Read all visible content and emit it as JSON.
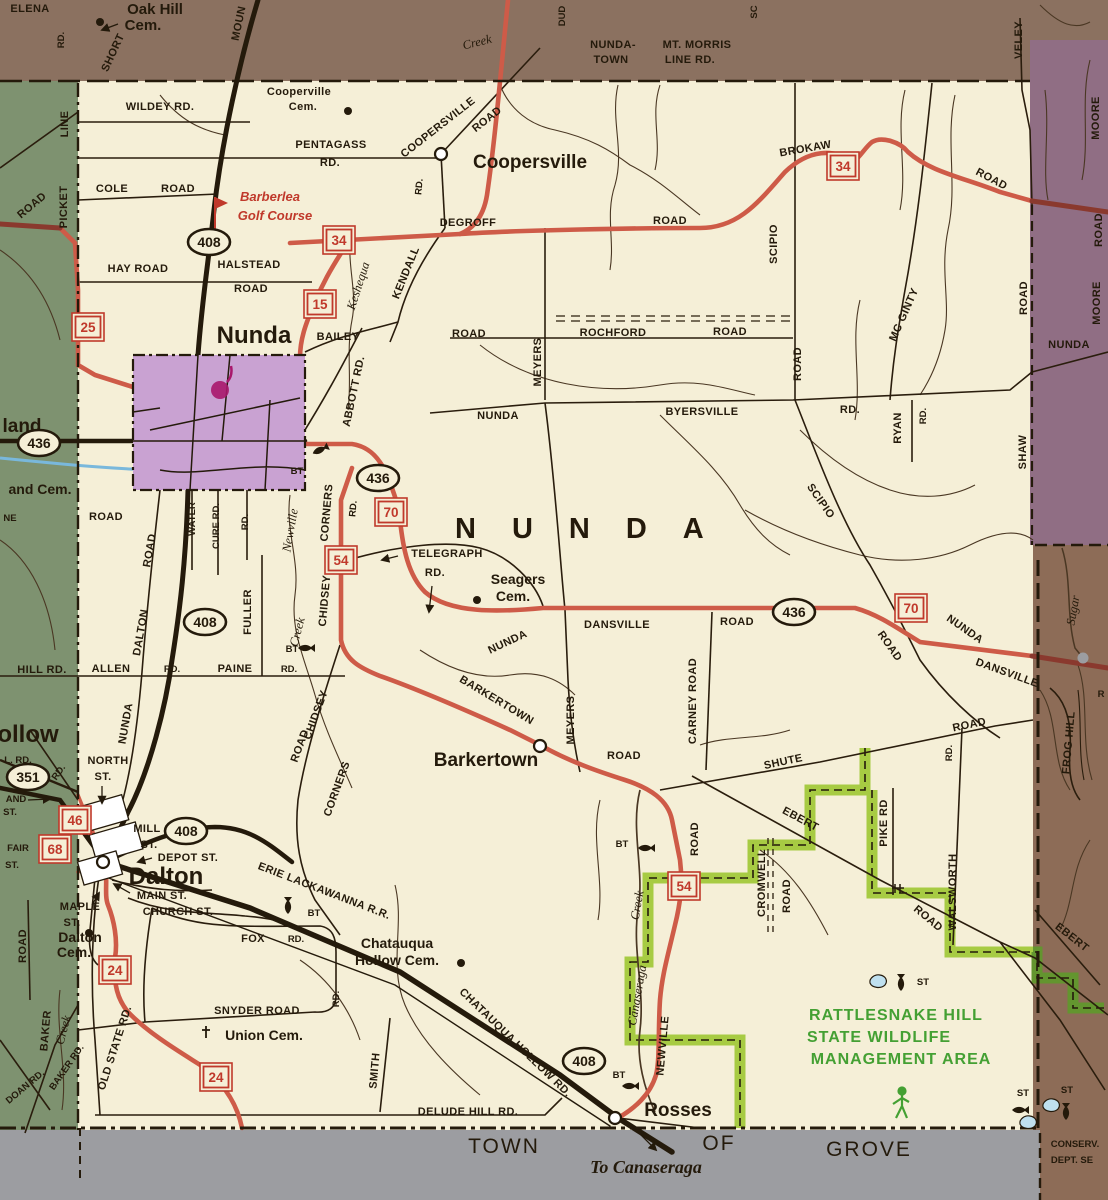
{
  "map_title": "Town of Nunda road map",
  "palette": {
    "cream": "#f5efd7",
    "brown_top": "#8b7160",
    "purple_east": "#906e84",
    "brown_east": "#8d6c57",
    "green_west": "#7e9270",
    "village_purple": "#c9a2d2",
    "gray_strip": "#9c9da1",
    "wildlife_green": "#a7cb43",
    "wildlife_dark": "#63952f",
    "route_red": "#ce5b48",
    "route_dark_red": "#8a392e",
    "ink": "#241a0b",
    "water_blue": "#79b8dc"
  },
  "labels": [
    {
      "t": "ELENA",
      "x": 30,
      "y": 12
    },
    {
      "t": "RD.",
      "x": 64,
      "y": 40,
      "r": -90,
      "c": "rds"
    },
    {
      "t": "Oak Hill",
      "x": 155,
      "y": 14,
      "c": "town",
      "fs": 15
    },
    {
      "t": "Cem.",
      "x": 143,
      "y": 30,
      "c": "town",
      "fs": 15
    },
    {
      "t": "SHORT",
      "x": 116,
      "y": 54,
      "r": -65
    },
    {
      "t": "MOUN",
      "x": 242,
      "y": 24,
      "r": -78
    },
    {
      "t": "Creek",
      "x": 478,
      "y": 46,
      "r": -14,
      "c": "creek"
    },
    {
      "t": "DUD",
      "x": 565,
      "y": 16,
      "r": -90,
      "c": "rds"
    },
    {
      "t": "NUNDA-",
      "x": 613,
      "y": 48
    },
    {
      "t": "TOWN",
      "x": 611,
      "y": 63
    },
    {
      "t": "MT. MORRIS",
      "x": 697,
      "y": 48
    },
    {
      "t": "LINE RD.",
      "x": 690,
      "y": 63
    },
    {
      "t": "SC",
      "x": 757,
      "y": 12,
      "r": -90,
      "c": "rds"
    },
    {
      "t": "VELEY",
      "x": 1022,
      "y": 40,
      "r": -90
    },
    {
      "t": "MOORE",
      "x": 1099,
      "y": 118,
      "r": -90
    },
    {
      "t": "ROAD",
      "x": 1102,
      "y": 230,
      "r": -90
    },
    {
      "t": "MOORE",
      "x": 1100,
      "y": 303,
      "r": -90
    },
    {
      "t": "NUNDA",
      "x": 1069,
      "y": 348
    },
    {
      "t": "WILDEY RD.",
      "x": 160,
      "y": 110
    },
    {
      "t": "Cooperville",
      "x": 299,
      "y": 95
    },
    {
      "t": "Cem.",
      "x": 303,
      "y": 110
    },
    {
      "t": "PENTAGASS",
      "x": 331,
      "y": 148
    },
    {
      "t": "RD.",
      "x": 330,
      "y": 166
    },
    {
      "t": "COOPERSVILLE",
      "x": 440,
      "y": 130,
      "r": -38
    },
    {
      "t": "ROAD",
      "x": 489,
      "y": 122,
      "r": -38
    },
    {
      "t": "Coopersville",
      "x": 530,
      "y": 168,
      "c": "town"
    },
    {
      "t": "COLE",
      "x": 112,
      "y": 192
    },
    {
      "t": "ROAD",
      "x": 178,
      "y": 192
    },
    {
      "t": "Barberlea",
      "x": 270,
      "y": 201,
      "c": "red-it"
    },
    {
      "t": "Golf Course",
      "x": 275,
      "y": 220,
      "c": "red-it"
    },
    {
      "t": "HAY ROAD",
      "x": 138,
      "y": 272
    },
    {
      "t": "HALSTEAD",
      "x": 249,
      "y": 268
    },
    {
      "t": "ROAD",
      "x": 251,
      "y": 292
    },
    {
      "t": "DEGROFF",
      "x": 468,
      "y": 226
    },
    {
      "t": "ROAD",
      "x": 670,
      "y": 224
    },
    {
      "t": "BROKAW",
      "x": 806,
      "y": 152,
      "r": -10
    },
    {
      "t": "ROAD",
      "x": 990,
      "y": 182,
      "r": 28
    },
    {
      "t": "KENDALL",
      "x": 409,
      "y": 274,
      "r": -68
    },
    {
      "t": "RD.",
      "x": 422,
      "y": 187,
      "r": -85,
      "c": "rds"
    },
    {
      "t": "Keshequa",
      "x": 362,
      "y": 287,
      "r": -72,
      "c": "creek"
    },
    {
      "t": "SCIPIO",
      "x": 777,
      "y": 244,
      "r": -90
    },
    {
      "t": "MC GINTY",
      "x": 907,
      "y": 316,
      "r": -66
    },
    {
      "t": "ROCHFORD",
      "x": 613,
      "y": 336
    },
    {
      "t": "ROAD",
      "x": 730,
      "y": 335
    },
    {
      "t": "ROAD",
      "x": 469,
      "y": 337
    },
    {
      "t": "MEYERS",
      "x": 541,
      "y": 362,
      "r": -90
    },
    {
      "t": "NUNDA",
      "x": 498,
      "y": 419
    },
    {
      "t": "BYERSVILLE",
      "x": 702,
      "y": 415
    },
    {
      "t": "RD.",
      "x": 850,
      "y": 413
    },
    {
      "t": "RYAN",
      "x": 901,
      "y": 428,
      "r": -90
    },
    {
      "t": "RD.",
      "x": 926,
      "y": 416,
      "r": -90,
      "c": "rds"
    },
    {
      "t": "ROAD",
      "x": 801,
      "y": 364,
      "r": -90
    },
    {
      "t": "SHAW",
      "x": 1026,
      "y": 452,
      "r": -90
    },
    {
      "t": "ROAD",
      "x": 1027,
      "y": 298,
      "r": -90
    },
    {
      "t": "BAILEY",
      "x": 338,
      "y": 340
    },
    {
      "t": "ABBOTT RD.",
      "x": 357,
      "y": 392,
      "r": -78
    },
    {
      "t": "Nunda",
      "x": 254,
      "y": 343,
      "c": "town-lg"
    },
    {
      "t": "BT",
      "x": 297,
      "y": 474,
      "c": "rds"
    },
    {
      "t": "NUNDA",
      "x": 455,
      "y": 538,
      "c": "spread",
      "an": "start"
    },
    {
      "t": "land",
      "x": 22,
      "y": 432,
      "c": "town"
    },
    {
      "t": "and Cem.",
      "x": 40,
      "y": 494,
      "c": "town",
      "fs": 14
    },
    {
      "t": "NE",
      "x": 10,
      "y": 521,
      "c": "rds"
    },
    {
      "t": "ROAD",
      "x": 106,
      "y": 520
    },
    {
      "t": "ROAD",
      "x": 34,
      "y": 208,
      "r": -40
    },
    {
      "t": "LINE",
      "x": 68,
      "y": 124,
      "r": -90
    },
    {
      "t": "PICKET",
      "x": 67,
      "y": 207,
      "r": -90
    },
    {
      "t": "HILL RD.",
      "x": 42,
      "y": 673
    },
    {
      "t": "ALLEN",
      "x": 111,
      "y": 672
    },
    {
      "t": "RD.",
      "x": 172,
      "y": 672,
      "c": "rds"
    },
    {
      "t": "PAINE",
      "x": 235,
      "y": 672
    },
    {
      "t": "RD.",
      "x": 289,
      "y": 672,
      "c": "rds"
    },
    {
      "t": "DALTON",
      "x": 144,
      "y": 633,
      "r": -80
    },
    {
      "t": "NUNDA",
      "x": 129,
      "y": 724,
      "r": -80
    },
    {
      "t": "ROAD",
      "x": 153,
      "y": 551,
      "r": -80
    },
    {
      "t": "WATER",
      "x": 195,
      "y": 519,
      "r": -90,
      "c": "rds"
    },
    {
      "t": "CURE RD.",
      "x": 219,
      "y": 526,
      "r": -90,
      "c": "rds"
    },
    {
      "t": "RD.",
      "x": 248,
      "y": 522,
      "r": -90,
      "c": "rds"
    },
    {
      "t": "FULLER",
      "x": 251,
      "y": 612,
      "r": -90
    },
    {
      "t": "Newville",
      "x": 294,
      "y": 531,
      "r": -80,
      "c": "creek"
    },
    {
      "t": "Creek",
      "x": 301,
      "y": 633,
      "r": -75,
      "c": "creek"
    },
    {
      "t": "CORNERS",
      "x": 330,
      "y": 513,
      "r": -85
    },
    {
      "t": "CHIDSEY",
      "x": 328,
      "y": 601,
      "r": -85
    },
    {
      "t": "RD.",
      "x": 356,
      "y": 509,
      "r": -85,
      "c": "rds"
    },
    {
      "t": "CHIDSEY",
      "x": 319,
      "y": 716,
      "r": -70
    },
    {
      "t": "CORNERS",
      "x": 340,
      "y": 790,
      "r": -70
    },
    {
      "t": "ROAD",
      "x": 303,
      "y": 747,
      "r": -70
    },
    {
      "t": "TELEGRAPH",
      "x": 447,
      "y": 557
    },
    {
      "t": "RD.",
      "x": 435,
      "y": 576
    },
    {
      "t": "Seagers",
      "x": 518,
      "y": 584,
      "c": "town",
      "fs": 14
    },
    {
      "t": "Cem.",
      "x": 513,
      "y": 601,
      "c": "town",
      "fs": 14
    },
    {
      "t": "NUNDA",
      "x": 509,
      "y": 645,
      "r": -25
    },
    {
      "t": "DANSVILLE",
      "x": 617,
      "y": 628
    },
    {
      "t": "ROAD",
      "x": 737,
      "y": 625
    },
    {
      "t": "NUNDA",
      "x": 963,
      "y": 632,
      "r": 35
    },
    {
      "t": "DANSVILLE",
      "x": 1006,
      "y": 676,
      "r": 20
    },
    {
      "t": "ROAD",
      "x": 887,
      "y": 648,
      "r": 55
    },
    {
      "t": "SCIPIO",
      "x": 818,
      "y": 503,
      "r": 55
    },
    {
      "t": "MEYERS",
      "x": 574,
      "y": 720,
      "r": -90
    },
    {
      "t": "ROAD",
      "x": 624,
      "y": 759
    },
    {
      "t": "BARKERTOWN",
      "x": 495,
      "y": 703,
      "r": 31
    },
    {
      "t": "Barkertown",
      "x": 486,
      "y": 766,
      "c": "town"
    },
    {
      "t": "CARNEY ROAD",
      "x": 696,
      "y": 701,
      "r": -90
    },
    {
      "t": "SHUTE",
      "x": 784,
      "y": 765,
      "r": -12
    },
    {
      "t": "ROAD",
      "x": 970,
      "y": 728,
      "r": -12
    },
    {
      "t": "EBERT",
      "x": 799,
      "y": 822,
      "r": 28
    },
    {
      "t": "ROAD",
      "x": 926,
      "y": 921,
      "r": 40
    },
    {
      "t": "EBERT",
      "x": 1070,
      "y": 940,
      "r": 38
    },
    {
      "t": "CROMWELL",
      "x": 765,
      "y": 883,
      "r": -90
    },
    {
      "t": "ROAD",
      "x": 790,
      "y": 896,
      "r": -90
    },
    {
      "t": "PIKE RD",
      "x": 887,
      "y": 823,
      "r": -90
    },
    {
      "t": "WALSWORTH",
      "x": 956,
      "y": 892,
      "r": -90
    },
    {
      "t": "RD.",
      "x": 952,
      "y": 753,
      "r": -90,
      "c": "rds"
    },
    {
      "t": "ROAD",
      "x": 698,
      "y": 839,
      "r": -90
    },
    {
      "t": "NEWVILLE",
      "x": 666,
      "y": 1046,
      "r": -85
    },
    {
      "t": "Creek",
      "x": 641,
      "y": 906,
      "r": -80,
      "c": "creek"
    },
    {
      "t": "Canaseraga",
      "x": 641,
      "y": 996,
      "r": -80,
      "c": "creek"
    },
    {
      "t": "BT",
      "x": 622,
      "y": 847,
      "c": "rds"
    },
    {
      "t": "BT",
      "x": 292,
      "y": 652,
      "c": "rds"
    },
    {
      "t": "RATTLESNAKE HILL",
      "x": 896,
      "y": 1020,
      "c": "green-l"
    },
    {
      "t": "STATE WILDLIFE",
      "x": 879,
      "y": 1042,
      "c": "green-l"
    },
    {
      "t": "MANAGEMENT AREA",
      "x": 901,
      "y": 1064,
      "c": "green-l"
    },
    {
      "t": "ST",
      "x": 923,
      "y": 985,
      "c": "rds"
    },
    {
      "t": "ST",
      "x": 1023,
      "y": 1096,
      "c": "rds"
    },
    {
      "t": "ST",
      "x": 1067,
      "y": 1093,
      "c": "rds"
    },
    {
      "t": "NORTH",
      "x": 108,
      "y": 764
    },
    {
      "t": "ST.",
      "x": 103,
      "y": 780
    },
    {
      "t": "MILL",
      "x": 147,
      "y": 832
    },
    {
      "t": "ST.",
      "x": 149,
      "y": 848
    },
    {
      "t": "DEPOT ST.",
      "x": 188,
      "y": 861
    },
    {
      "t": "Dalton",
      "x": 166,
      "y": 884,
      "c": "town-lg"
    },
    {
      "t": "MAIN ST.",
      "x": 162,
      "y": 899
    },
    {
      "t": "CHURCH ST.",
      "x": 178,
      "y": 915
    },
    {
      "t": "MAPLE",
      "x": 80,
      "y": 910
    },
    {
      "t": "ST.",
      "x": 72,
      "y": 926
    },
    {
      "t": "Dalton",
      "x": 80,
      "y": 942,
      "c": "town",
      "fs": 14
    },
    {
      "t": "Cem.",
      "x": 74,
      "y": 957,
      "c": "town",
      "fs": 14
    },
    {
      "t": "FOX",
      "x": 253,
      "y": 942
    },
    {
      "t": "RD.",
      "x": 296,
      "y": 942,
      "c": "rds"
    },
    {
      "t": "RD.",
      "x": 339,
      "y": 999,
      "r": -90,
      "c": "rds"
    },
    {
      "t": "SNYDER ROAD",
      "x": 257,
      "y": 1014
    },
    {
      "t": "Union Cem.",
      "x": 264,
      "y": 1040,
      "c": "town",
      "fs": 14
    },
    {
      "t": "OLD STATE RD.",
      "x": 118,
      "y": 1049,
      "r": -72
    },
    {
      "t": "ERIE LACKAWANNA R.R.",
      "x": 323,
      "y": 894,
      "r": 21
    },
    {
      "t": "CHATAUQUA HOLLOW RD.",
      "x": 513,
      "y": 1045,
      "r": 44
    },
    {
      "t": "Chatauqua",
      "x": 397,
      "y": 948,
      "c": "town",
      "fs": 14
    },
    {
      "t": "Hollow Cem.",
      "x": 397,
      "y": 965,
      "c": "town",
      "fs": 14
    },
    {
      "t": "SMITH",
      "x": 378,
      "y": 1071,
      "r": -85
    },
    {
      "t": "DELUDE  HILL  RD.",
      "x": 468,
      "y": 1115
    },
    {
      "t": "Rosses",
      "x": 678,
      "y": 1116,
      "c": "town"
    },
    {
      "t": "To Canaseraga",
      "x": 646,
      "y": 1173,
      "c": "dest"
    },
    {
      "t": "TOWN",
      "x": 504,
      "y": 1153,
      "c": "strip"
    },
    {
      "t": "OF",
      "x": 719,
      "y": 1150,
      "c": "strip"
    },
    {
      "t": "GROVE",
      "x": 869,
      "y": 1156,
      "c": "strip"
    },
    {
      "t": "CONSERV.",
      "x": 1075,
      "y": 1147,
      "c": "rds"
    },
    {
      "t": "DEPT. SE",
      "x": 1072,
      "y": 1163,
      "c": "rds"
    },
    {
      "t": "Sugar",
      "x": 1077,
      "y": 611,
      "r": -80,
      "c": "creek"
    },
    {
      "t": "FROG HILL",
      "x": 1072,
      "y": 743,
      "r": -85
    },
    {
      "t": "R",
      "x": 1101,
      "y": 697,
      "c": "rds"
    },
    {
      "t": "BT",
      "x": 314,
      "y": 916,
      "c": "rds"
    },
    {
      "t": "BT",
      "x": 619,
      "y": 1078,
      "c": "rds"
    },
    {
      "t": "AND",
      "x": 16,
      "y": 802,
      "c": "rds"
    },
    {
      "t": "ST.",
      "x": 10,
      "y": 815,
      "c": "rds"
    },
    {
      "t": "FAIR",
      "x": 18,
      "y": 851,
      "c": "rds"
    },
    {
      "t": "ST.",
      "x": 12,
      "y": 868,
      "c": "rds"
    },
    {
      "t": "L. RD.",
      "x": 18,
      "y": 763,
      "c": "rds"
    },
    {
      "t": "RD.",
      "x": 61,
      "y": 774,
      "r": -55,
      "c": "rds"
    },
    {
      "t": "ollow",
      "x": 28,
      "y": 742,
      "c": "town-lg"
    },
    {
      "t": "ROAD",
      "x": 26,
      "y": 946,
      "r": -90
    },
    {
      "t": "BAKER",
      "x": 49,
      "y": 1031,
      "r": -85
    },
    {
      "t": "BAKER RD.",
      "x": 69,
      "y": 1069,
      "r": -55,
      "c": "rds"
    },
    {
      "t": "Creek",
      "x": 67,
      "y": 1031,
      "r": -75,
      "c": "creek"
    },
    {
      "t": "DOAN RD.",
      "x": 27,
      "y": 1089,
      "r": -40,
      "c": "rds"
    }
  ],
  "shields": [
    {
      "k": "box",
      "t": "25",
      "x": 88,
      "y": 327
    },
    {
      "k": "box",
      "t": "34",
      "x": 339,
      "y": 240
    },
    {
      "k": "box",
      "t": "15",
      "x": 320,
      "y": 304
    },
    {
      "k": "box",
      "t": "34",
      "x": 843,
      "y": 166
    },
    {
      "k": "oval",
      "t": "408",
      "x": 209,
      "y": 242
    },
    {
      "k": "oval",
      "t": "408",
      "x": 205,
      "y": 622
    },
    {
      "k": "oval",
      "t": "408",
      "x": 186,
      "y": 831
    },
    {
      "k": "oval",
      "t": "408",
      "x": 584,
      "y": 1061
    },
    {
      "k": "oval",
      "t": "436",
      "x": 39,
      "y": 443
    },
    {
      "k": "oval",
      "t": "436",
      "x": 378,
      "y": 478
    },
    {
      "k": "oval",
      "t": "436",
      "x": 794,
      "y": 612
    },
    {
      "k": "box",
      "t": "70",
      "x": 391,
      "y": 512
    },
    {
      "k": "box",
      "t": "70",
      "x": 911,
      "y": 608
    },
    {
      "k": "box",
      "t": "54",
      "x": 341,
      "y": 560
    },
    {
      "k": "box",
      "t": "54",
      "x": 684,
      "y": 886
    },
    {
      "k": "box",
      "t": "46",
      "x": 75,
      "y": 820
    },
    {
      "k": "box",
      "t": "68",
      "x": 55,
      "y": 849
    },
    {
      "k": "box",
      "t": "24",
      "x": 115,
      "y": 970
    },
    {
      "k": "box",
      "t": "24",
      "x": 216,
      "y": 1077
    },
    {
      "k": "oval",
      "t": "351",
      "x": 28,
      "y": 777
    }
  ],
  "icons": [
    {
      "k": "fish",
      "x": 320,
      "y": 450,
      "r": -25
    },
    {
      "k": "fish",
      "x": 306,
      "y": 648
    },
    {
      "k": "fish",
      "x": 646,
      "y": 848
    },
    {
      "k": "fish",
      "x": 288,
      "y": 906,
      "r": -90
    },
    {
      "k": "fish",
      "x": 630,
      "y": 1086
    },
    {
      "k": "fish",
      "x": 901,
      "y": 983,
      "r": -90
    },
    {
      "k": "fish",
      "x": 1020,
      "y": 1110
    },
    {
      "k": "fish",
      "x": 1066,
      "y": 1112,
      "r": -90
    },
    {
      "k": "pond",
      "x": 878,
      "y": 981
    },
    {
      "k": "pond",
      "x": 1028,
      "y": 1122
    },
    {
      "k": "pond",
      "x": 1051,
      "y": 1105
    },
    {
      "k": "dot",
      "x": 100,
      "y": 22
    },
    {
      "k": "dot",
      "x": 348,
      "y": 111
    },
    {
      "k": "dot",
      "x": 477,
      "y": 600
    },
    {
      "k": "dot",
      "x": 461,
      "y": 963
    },
    {
      "k": "dot",
      "x": 89,
      "y": 933
    },
    {
      "k": "cross",
      "x": 206,
      "y": 1032
    },
    {
      "k": "circle",
      "x": 441,
      "y": 154
    },
    {
      "k": "circle",
      "x": 540,
      "y": 746
    },
    {
      "k": "circle",
      "x": 615,
      "y": 1118
    },
    {
      "k": "circle",
      "x": 103,
      "y": 862
    },
    {
      "k": "graydot",
      "x": 1083,
      "y": 658
    },
    {
      "k": "hiker",
      "x": 902,
      "y": 1104
    },
    {
      "k": "flag",
      "x": 215,
      "y": 205
    },
    {
      "k": "stamp",
      "x": 220,
      "y": 390
    },
    {
      "k": "struct",
      "x": 895,
      "y": 884
    }
  ]
}
